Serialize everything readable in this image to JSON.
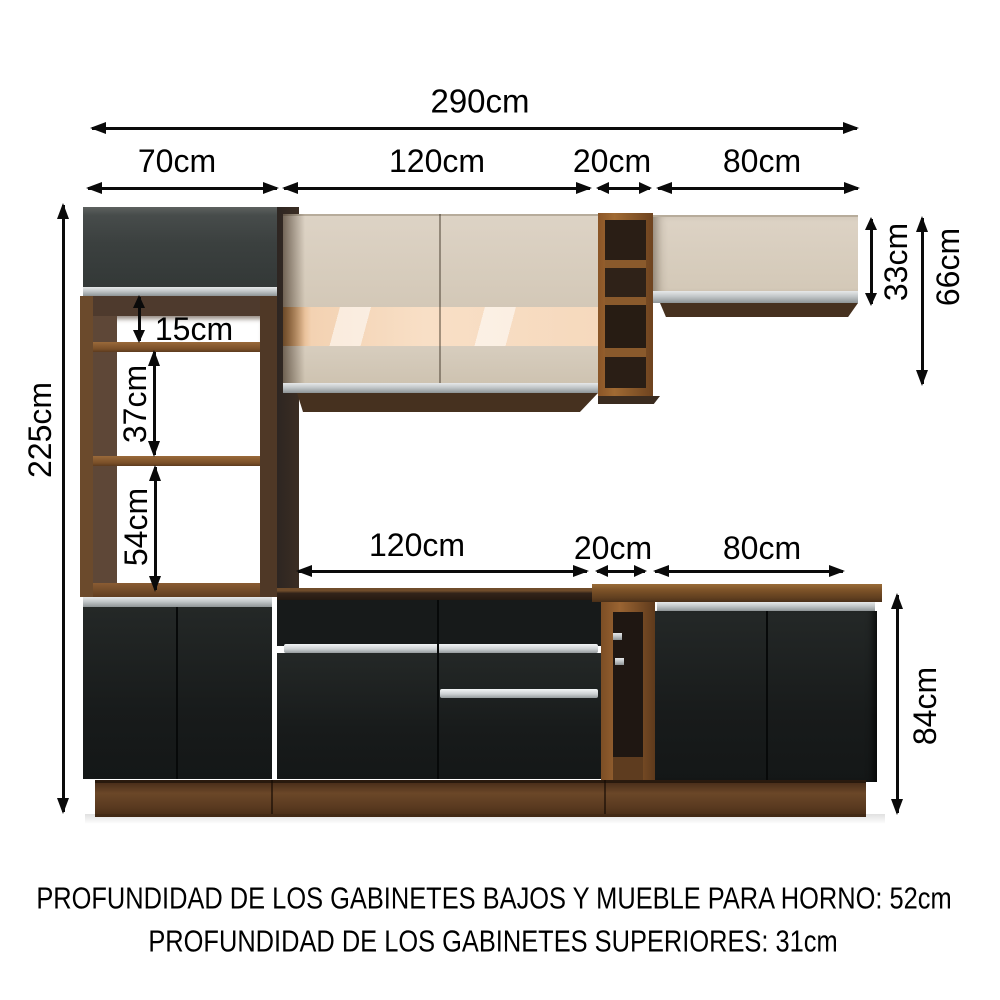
{
  "diagram": {
    "labels": {
      "total_width": "290cm",
      "top_70": "70cm",
      "top_120": "120cm",
      "top_20": "20cm",
      "top_80": "80cm",
      "height_total": "225cm",
      "opening_15": "15cm",
      "opening_37": "37cm",
      "opening_54": "54cm",
      "upper_cabinet_height": "33cm",
      "upper_shelf_height": "66cm",
      "mid_120": "120cm",
      "mid_20": "20cm",
      "mid_80": "80cm",
      "base_height": "84cm"
    },
    "notes": [
      "PROFUNDIDAD DE LOS GABINETES BAJOS Y MUEBLE PARA HORNO: 52cm",
      "PROFUNDIDAD DE LOS GABINETES SUPERIORES: 31cm"
    ],
    "colors": {
      "dimension_ink": "#0a0a0a",
      "wood": "#6b4526",
      "wood_light": "#8a5c33",
      "cream_door": "#d6ccbc",
      "glass_glow": "#f7ddc3",
      "charcoal_door": "#3e4342",
      "black_door": "#1b1e1e",
      "silver_trim": "#c2c7c9",
      "interior_dark": "#2b2017",
      "background": "#ffffff"
    }
  }
}
